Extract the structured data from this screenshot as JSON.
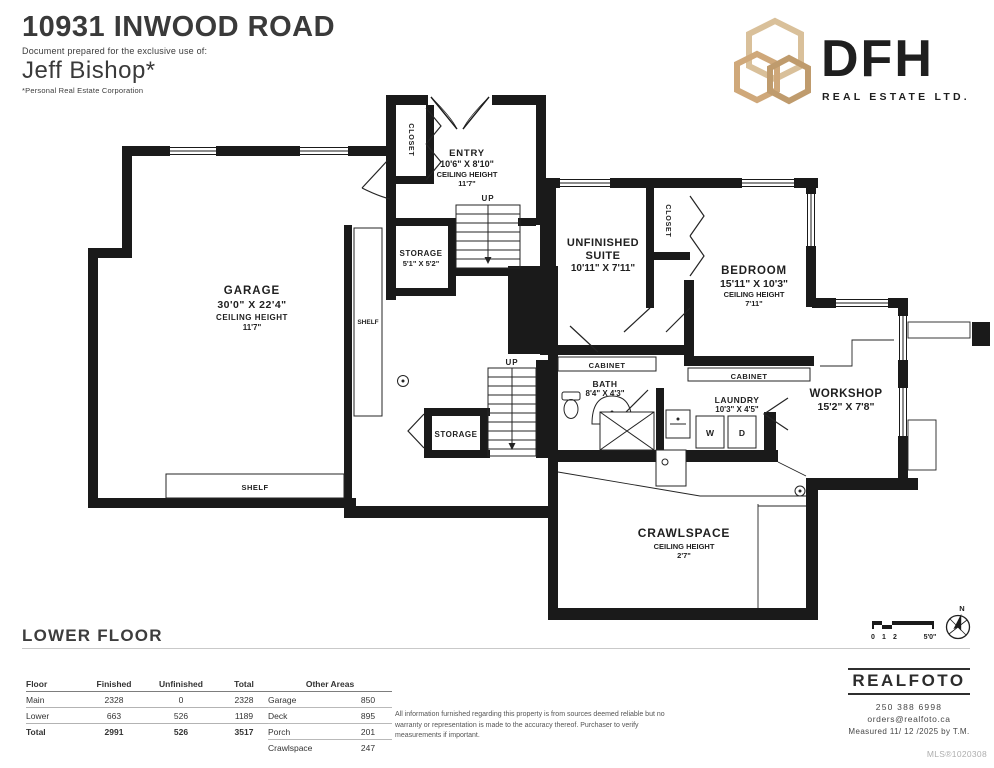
{
  "header": {
    "address": "10931 INWOOD ROAD",
    "prepared_for": "Document prepared for the exclusive use of:",
    "agent_name": "Jeff Bishop*",
    "agent_note": "*Personal Real Estate Corporation"
  },
  "brand": {
    "name": "DFH",
    "sub": "REAL ESTATE LTD.",
    "navy": "#1d3c5f",
    "gold": "#c2a074"
  },
  "floor_label": "LOWER FLOOR",
  "rooms": {
    "garage": {
      "name": "GARAGE",
      "dims": "30'0\" X 22'4\"",
      "ch": "CEILING HEIGHT",
      "chv": "11'7\""
    },
    "entry": {
      "name": "ENTRY",
      "dims": "10'6\" X 8'10\"",
      "ch": "CEILING HEIGHT",
      "chv": "11'7\""
    },
    "storage1": {
      "name": "STORAGE",
      "dims": "5'1\" X 5'2\""
    },
    "suite": {
      "name1": "UNFINISHED",
      "name2": "SUITE",
      "dims": "10'11\" X 7'11\""
    },
    "bedroom": {
      "name": "BEDROOM",
      "dims": "15'11\" X 10'3\"",
      "ch": "CEILING HEIGHT",
      "chv": "7'11\""
    },
    "bath": {
      "name": "BATH",
      "dims": "8'4\" X 4'3\""
    },
    "laundry": {
      "name": "LAUNDRY",
      "dims": "10'3\" X 4'5\""
    },
    "workshop": {
      "name": "WORKSHOP",
      "dims": "15'2\" X 7'8\""
    },
    "crawlspace": {
      "name": "CRAWLSPACE",
      "ch": "CEILING HEIGHT",
      "chv": "2'7\""
    },
    "storage2": {
      "name": "STORAGE"
    }
  },
  "features": {
    "closet_entry": "CLOSET",
    "closet_bedroom": "CLOSET",
    "shelf_side": "SHELF",
    "shelf_bottom": "SHELF",
    "cabinet_bath": "CABINET",
    "cabinet_bedroom": "CABINET",
    "up1": "UP",
    "up2": "UP",
    "washer": "W",
    "dryer": "D"
  },
  "scale": {
    "t0": "0",
    "t1": "1",
    "t2": "2",
    "max": "5'0\"",
    "north": "N"
  },
  "area_table": {
    "headers": [
      "Floor",
      "Finished",
      "Unfinished",
      "Total"
    ],
    "rows": [
      [
        "Main",
        "2328",
        "0",
        "2328"
      ],
      [
        "Lower",
        "663",
        "526",
        "1189"
      ]
    ],
    "total": [
      "Total",
      "2991",
      "526",
      "3517"
    ]
  },
  "other_areas": {
    "title": "Other Areas",
    "rows": [
      [
        "Garage",
        "850"
      ],
      [
        "Deck",
        "895"
      ],
      [
        "Porch",
        "201"
      ],
      [
        "Crawlspace",
        "247"
      ]
    ]
  },
  "disclaimer": "All information furnished regarding this property is from sources deemed reliable but no warranty or representation is made to the accuracy thereof. Purchaser to verify measurements if important.",
  "realfoto": {
    "name": "REALFOTO",
    "phone": "250 388 6998",
    "email": "orders@realfoto.ca",
    "measured": "Measured  11/ 12 /2025 by T.M.",
    "mls": "MLS®1020308"
  }
}
